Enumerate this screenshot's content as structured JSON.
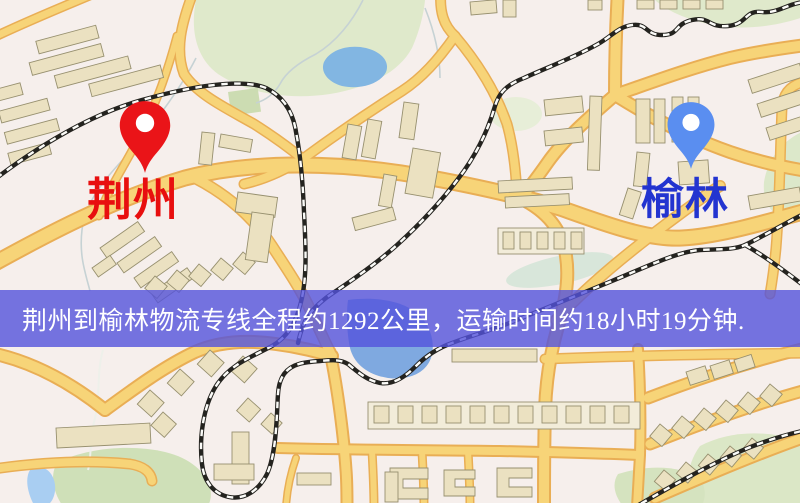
{
  "banner": {
    "text": "荆州到榆林物流专线全程约1292公里，运输时间约18小时19分钟.",
    "background_color": "#5452dc",
    "text_color": "#ffffff"
  },
  "markers": [
    {
      "id": "origin",
      "label": "荆州",
      "pin_color": "#ea1418",
      "label_color": "#e80f0f",
      "icon": "map-pin-icon"
    },
    {
      "id": "destination",
      "label": "榆林",
      "pin_color": "#5a8ef0",
      "label_color": "#2334d0",
      "icon": "map-pin-icon"
    }
  ],
  "map": {
    "kind": "street-map",
    "colors": {
      "background": "#f6efec",
      "road_fill": "#f7d478",
      "road_casing": "#e9ae55",
      "building": "#ebe1c1",
      "park": "#dfe9cb",
      "water": "#82b6e2",
      "railway": "#24231f"
    }
  }
}
